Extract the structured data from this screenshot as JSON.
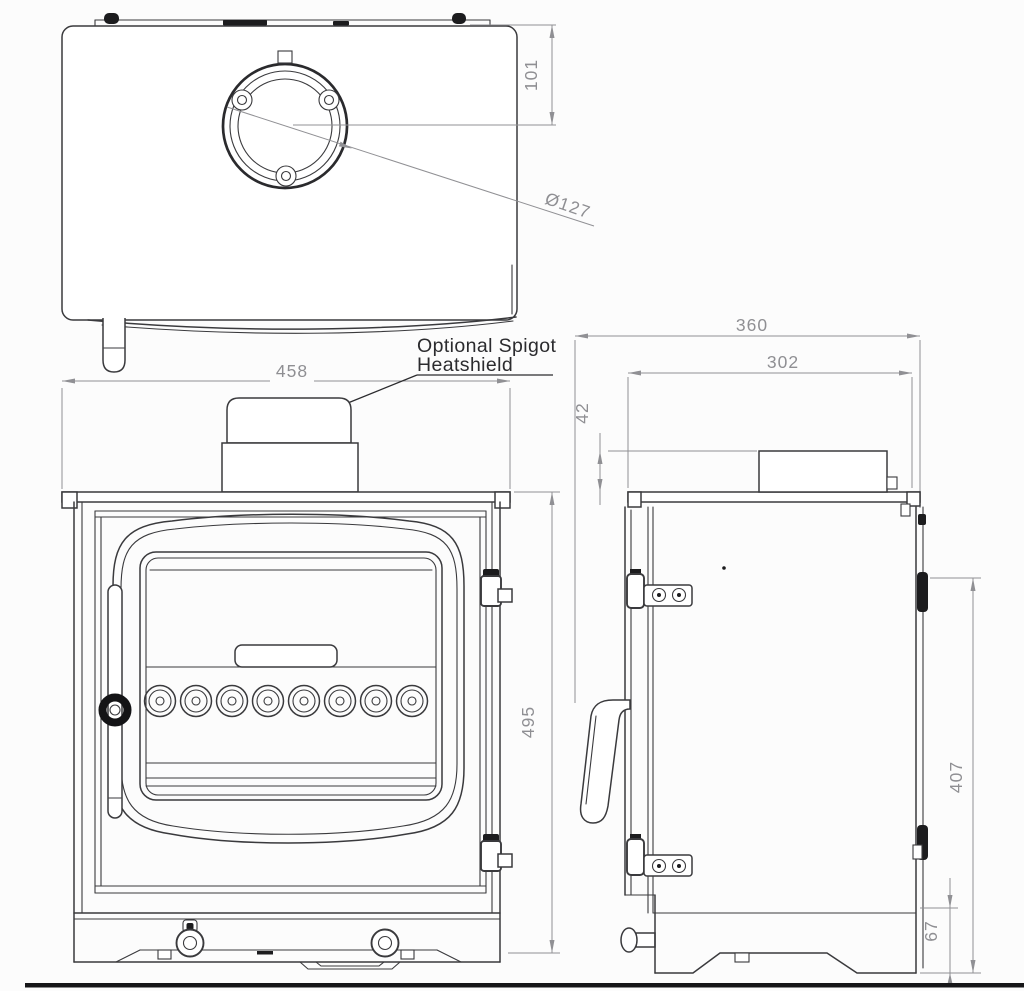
{
  "page": {
    "title": "Wood stove three-view technical drawing",
    "background": "#fcfcfc"
  },
  "annotation": {
    "line1": "Optional Spigot",
    "line2": "Heatshield"
  },
  "dimensions": {
    "flue_centre_offset": "101",
    "flue_diameter": "Ø127",
    "overall_width": "458",
    "overall_height": "495",
    "overall_depth": "360",
    "top_plate_depth": "302",
    "spigot_height": "42",
    "rear_panel_height": "407",
    "base_height": "67"
  },
  "colors": {
    "outline": "#3a3a3d",
    "dark_detail": "#1c1c1e",
    "dimension_lines": "#909094",
    "dimension_text": "#8f8f93",
    "annotation_text": "#2b2b2e",
    "floor_line": "#161618",
    "background": "#fcfcfc"
  }
}
